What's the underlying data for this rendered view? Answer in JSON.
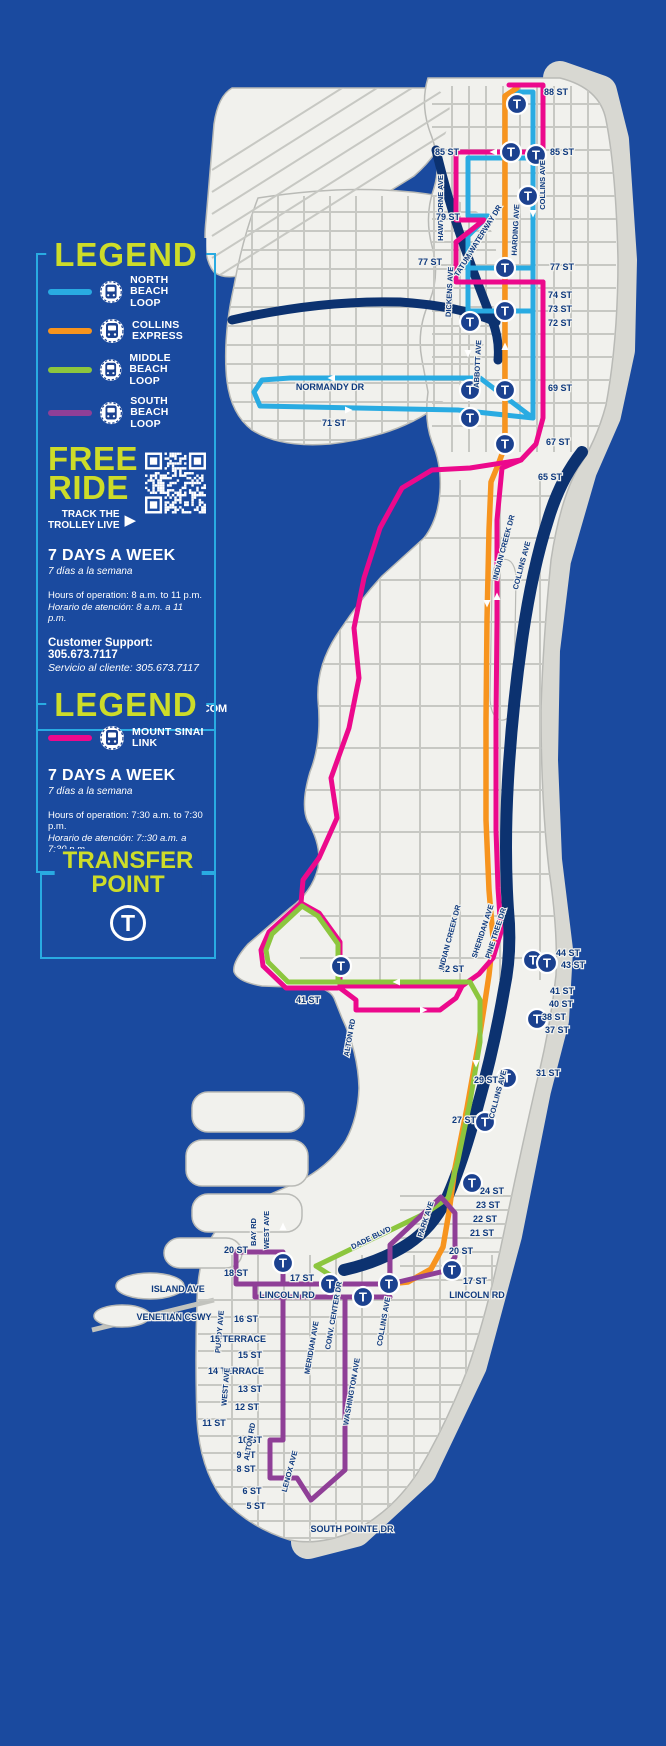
{
  "colors": {
    "background": "#1a4a9f",
    "accent_cyan": "#29abe2",
    "title_yellow": "#cddc29",
    "water_dark": "#0c3270",
    "land": "#f1f1ed",
    "sand": "#d8d8d2",
    "street": "#c7c8c3",
    "t_icon_blue": "#1b418f",
    "north_beach": "#29abe2",
    "collins_express": "#f7941e",
    "middle_beach": "#8cc63e",
    "south_beach": "#8f3f97",
    "mount_sinai": "#ec098c"
  },
  "legend1": {
    "title": "LEGEND",
    "routes": [
      {
        "label1": "NORTH BEACH",
        "label2": "LOOP",
        "color": "#29abe2"
      },
      {
        "label1": "COLLINS",
        "label2": "EXPRESS",
        "color": "#f7941e"
      },
      {
        "label1": "MIDDLE BEACH",
        "label2": "LOOP",
        "color": "#8cc63e"
      },
      {
        "label1": "SOUTH BEACH",
        "label2": "LOOP",
        "color": "#8f3f97"
      }
    ],
    "free_line1": "FREE",
    "free_line2": "RIDE",
    "track1": "TRACK THE",
    "track2": "TROLLEY LIVE",
    "track_arrow": "▶",
    "days": "7 DAYS A WEEK",
    "days_es": "7 días a la semana",
    "hours": "Hours of operation: 8 a.m. to 11 p.m.",
    "hours_es": "Horario de atención: 8 a.m. a 11 p.m.",
    "support": "Customer Support: 305.673.7117",
    "support_es": "Servicio al cliente: 305.673.7117",
    "email": "Email: trolley@miamibeachfl.gov",
    "website": "WWW.MIAMIBEACHTROLLEY.COM"
  },
  "legend2": {
    "title": "LEGEND",
    "routes": [
      {
        "label1": "MOUNT SINAI",
        "label2": "LINK",
        "color": "#ec098c"
      }
    ],
    "days": "7 DAYS A WEEK",
    "days_es": "7 días a la semana",
    "hours": "Hours of operation: 7:30 a.m. to 7:30 p.m.",
    "hours_es": "Horario de atención: 7::30 a.m. a 7:30 p.m."
  },
  "transfer_point": {
    "title_line1": "TRANSFER",
    "title_line2": "POINT",
    "symbol": "T"
  },
  "map": {
    "transfer_symbol": "T",
    "street_labels": [
      [
        "88 ST",
        556,
        95,
        0
      ],
      [
        "85 ST",
        447,
        155,
        0
      ],
      [
        "85 ST",
        562,
        155,
        0
      ],
      [
        "HAWTHORNE AVE",
        443,
        208,
        -90
      ],
      [
        "TATUM WATERWAY DR",
        480,
        242,
        -58
      ],
      [
        "HARDING AVE",
        518,
        230,
        -87
      ],
      [
        "COLLINS AVE",
        545,
        185,
        -90
      ],
      [
        "79 ST",
        448,
        220,
        0
      ],
      [
        "77 ST",
        430,
        265,
        0
      ],
      [
        "77 ST",
        562,
        270,
        0
      ],
      [
        "DICKENS AVE",
        452,
        292,
        -87
      ],
      [
        "74 ST",
        560,
        298,
        0
      ],
      [
        "73 ST",
        560,
        312,
        0
      ],
      [
        "72 ST",
        560,
        326,
        0
      ],
      [
        "ABBOTT AVE",
        480,
        364,
        -87
      ],
      [
        "69 ST",
        560,
        391,
        0
      ],
      [
        "67 ST",
        558,
        445,
        0
      ],
      [
        "65 ST",
        550,
        480,
        0
      ],
      [
        "NORMANDY DR",
        330,
        390,
        0
      ],
      [
        "71 ST",
        334,
        426,
        0
      ],
      [
        "INDIAN CREEK DR",
        506,
        548,
        -75
      ],
      [
        "COLLINS AVE",
        524,
        566,
        -75
      ],
      [
        "SHERIDAN AVE",
        485,
        932,
        -72
      ],
      [
        "PINE TREE DR",
        498,
        934,
        -72
      ],
      [
        "42 ST",
        452,
        972,
        0
      ],
      [
        "44 ST",
        568,
        956,
        0
      ],
      [
        "43 ST",
        573,
        968,
        0
      ],
      [
        "41 ST",
        562,
        994,
        0
      ],
      [
        "40 ST",
        561,
        1007,
        0
      ],
      [
        "38 ST",
        554,
        1020,
        0
      ],
      [
        "37 ST",
        557,
        1033,
        0
      ],
      [
        "41 ST",
        308,
        1003,
        0
      ],
      [
        "ALTON RD",
        352,
        1038,
        -80
      ],
      [
        "INDIAN CREEK DR",
        452,
        938,
        -75
      ],
      [
        "COLLINS AVE",
        500,
        1095,
        -75
      ],
      [
        "31 ST",
        548,
        1076,
        0
      ],
      [
        "29 ST",
        486,
        1083,
        0
      ],
      [
        "27 ST",
        464,
        1123,
        0
      ],
      [
        "24 ST",
        492,
        1194,
        0
      ],
      [
        "23 ST",
        488,
        1208,
        0
      ],
      [
        "22 ST",
        485,
        1222,
        0
      ],
      [
        "21 ST",
        482,
        1236,
        0
      ],
      [
        "20 ST",
        461,
        1254,
        0
      ],
      [
        "PARK AVE",
        428,
        1220,
        -72
      ],
      [
        "DADE BLVD",
        372,
        1240,
        -26
      ],
      [
        "20 ST",
        236,
        1253,
        0
      ],
      [
        "18 ST",
        236,
        1276,
        0
      ],
      [
        "BAY RD",
        256,
        1232,
        -90
      ],
      [
        "WEST AVE",
        269,
        1230,
        -90
      ],
      [
        "ISLAND AVE",
        178,
        1292,
        0
      ],
      [
        "VENETIAN CSWY",
        174,
        1320,
        0
      ],
      [
        "PURDY AVE",
        222,
        1332,
        -85
      ],
      [
        "17 ST",
        302,
        1281,
        0
      ],
      [
        "LINCOLN RD",
        287,
        1298,
        0
      ],
      [
        "17 ST",
        475,
        1284,
        0
      ],
      [
        "LINCOLN RD",
        477,
        1298,
        0
      ],
      [
        "CONV. CENTER DR",
        336,
        1316,
        -80
      ],
      [
        "MERIDIAN AVE",
        314,
        1348,
        -80
      ],
      [
        "WASHINGTON AVE",
        354,
        1392,
        -80
      ],
      [
        "COLLINS AVE",
        386,
        1322,
        -80
      ],
      [
        "16 ST",
        246,
        1322,
        0
      ],
      [
        "15 TERRACE",
        238,
        1342,
        0
      ],
      [
        "15 ST",
        250,
        1358,
        0
      ],
      [
        "14 TERRACE",
        236,
        1374,
        0
      ],
      [
        "13 ST",
        250,
        1392,
        0
      ],
      [
        "12 ST",
        247,
        1410,
        0
      ],
      [
        "11 ST",
        214,
        1426,
        0
      ],
      [
        "10 ST",
        250,
        1443,
        0
      ],
      [
        "9 ST",
        246,
        1458,
        0
      ],
      [
        "8 ST",
        246,
        1472,
        0
      ],
      [
        "6 ST",
        252,
        1494,
        0
      ],
      [
        "5 ST",
        256,
        1509,
        0
      ],
      [
        "ALTON RD",
        252,
        1442,
        -80
      ],
      [
        "LENOX AVE",
        292,
        1472,
        -75
      ],
      [
        "WEST AVE",
        228,
        1387,
        -85
      ],
      [
        "SOUTH POINTE DR",
        352,
        1532,
        0
      ]
    ],
    "routes": [
      {
        "name": "north-beach-loop",
        "color": "#29abe2",
        "w": 5,
        "segs": [
          "515,92 533,92 533,418",
          "533,158 468,158 468,216 488,216 468,236 468,268 533,268",
          "468,268 468,311 533,311",
          "533,418 480,378 290,378 262,380 254,392 260,406 458,410 533,418"
        ]
      },
      {
        "name": "collins-express",
        "color": "#f7941e",
        "w": 5.5,
        "segs": [
          "517,88 505,96 505,446 498,465 491,482 489,530 487,620 486,720 486,820 489,890 493,938 489,975 484,1008 478,1046 467,1108 455,1168 449,1212 443,1247 431,1269 408,1282 388,1284"
        ]
      },
      {
        "name": "mount-sinai-link",
        "color": "#ec098c",
        "w": 5,
        "segs": [
          "509,85 543,85 543,152 456,152 456,220 484,220 456,242 456,282 543,282",
          "543,282 543,418 536,444 521,460 502,468 497,520 497,620 496,720 496,830 498,888 501,932 493,958 479,974 462,986",
          "462,986 372,986",
          "372,986 340,986 340,942 319,913 301,903 269,932 261,950 263,966 286,988 338,988",
          "340,988 356,1000 356,1010 440,1010 456,998 462,986",
          "521,460 470,468 432,470 402,488 380,528 364,578 354,628 359,678 349,728 331,778 337,818 319,858 303,880 301,903"
        ]
      },
      {
        "name": "middle-beach-loop",
        "color": "#8cc63e",
        "w": 5,
        "segs": [
          "338,982 470,982",
          "338,982 338,944 318,916 302,906 272,934 266,950 268,962 288,982 338,982",
          "470,982 480,1000 480,1042 470,1102 458,1160 448,1198 426,1213 316,1266",
          "316,1266 330,1275 330,1284"
        ]
      },
      {
        "name": "south-beach-loop",
        "color": "#8f3f97",
        "w": 5,
        "segs": [
          "236,1252 283,1252 283,1284 236,1284 236,1252",
          "255,1284 390,1284",
          "255,1297 390,1297",
          "255,1284 255,1297",
          "283,1297 283,1440 270,1440 270,1478 297,1478 311,1500 345,1470 345,1297",
          "390,1284 390,1245 424,1213 441,1197 455,1213 455,1257 445,1271 390,1284"
        ]
      }
    ],
    "arrows": [
      [
        497,
        152,
        180
      ],
      [
        335,
        378,
        180
      ],
      [
        345,
        410,
        0
      ],
      [
        487,
        600,
        90
      ],
      [
        497,
        600,
        270
      ],
      [
        533,
        210,
        90
      ],
      [
        468,
        350,
        90
      ],
      [
        505,
        350,
        270
      ],
      [
        476,
        1060,
        90
      ],
      [
        283,
        1230,
        270
      ],
      [
        400,
        982,
        180
      ],
      [
        420,
        1010,
        0
      ]
    ],
    "transfer_points": [
      [
        517,
        104
      ],
      [
        511,
        152
      ],
      [
        536,
        155
      ],
      [
        528,
        196
      ],
      [
        505,
        268
      ],
      [
        505,
        311
      ],
      [
        470,
        322
      ],
      [
        470,
        390
      ],
      [
        505,
        390
      ],
      [
        470,
        418
      ],
      [
        505,
        444
      ],
      [
        341,
        966
      ],
      [
        533,
        960
      ],
      [
        547,
        963
      ],
      [
        537,
        1019
      ],
      [
        507,
        1078
      ],
      [
        485,
        1122
      ],
      [
        472,
        1183
      ],
      [
        452,
        1270
      ],
      [
        389,
        1284
      ],
      [
        363,
        1297
      ],
      [
        330,
        1284
      ],
      [
        283,
        1263
      ]
    ]
  }
}
